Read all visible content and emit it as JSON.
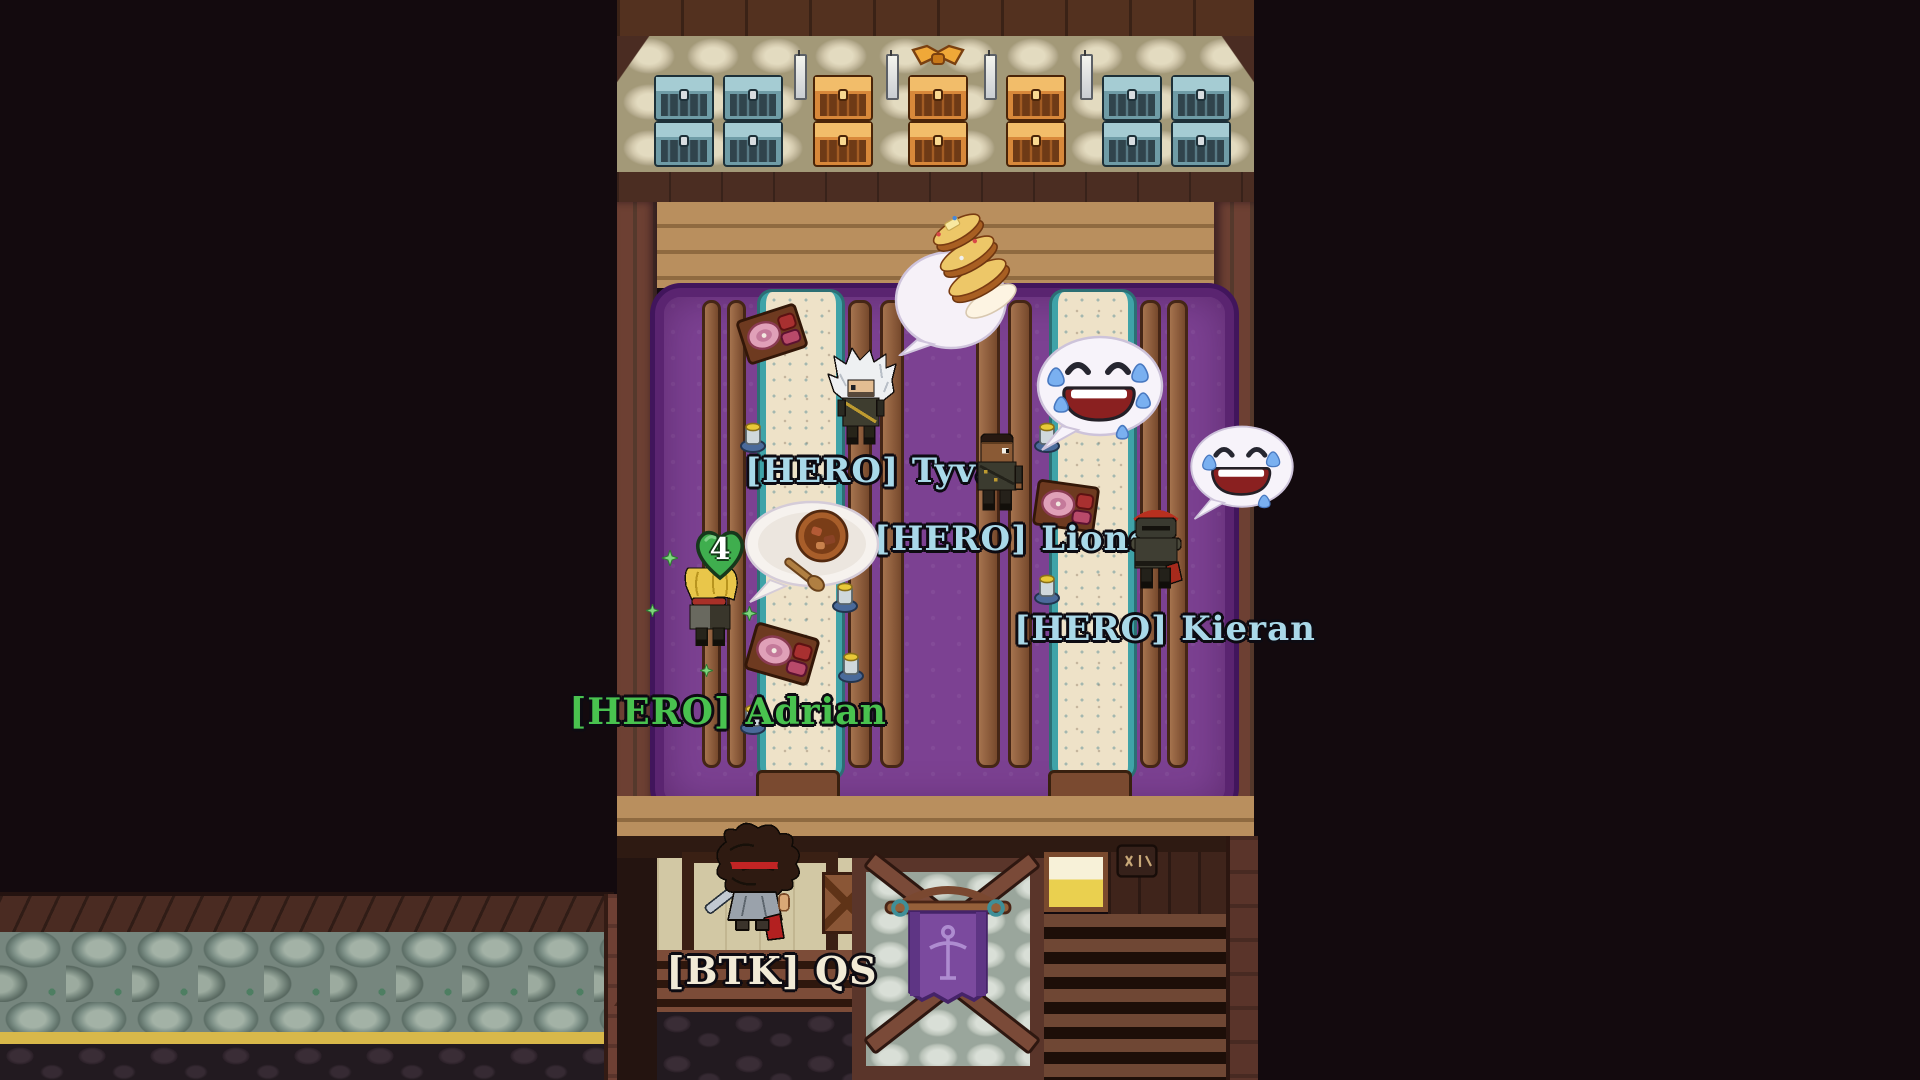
{
  "scene": {
    "name": "tavern-hall"
  },
  "players": [
    {
      "id": "tyva",
      "guild_tag": "[HERO]",
      "name": "Tyva",
      "label": "[HERO] Tyva",
      "label_color": "#a9d9e9"
    },
    {
      "id": "lionel",
      "guild_tag": "[HERO]",
      "name": "Lionel",
      "label": "[HERO] Lionel",
      "label_color": "#a9d9e9"
    },
    {
      "id": "kieran",
      "guild_tag": "[HERO]",
      "name": "Kieran",
      "label": "[HERO] Kieran",
      "label_color": "#a9d9e9"
    },
    {
      "id": "adrian",
      "guild_tag": "[HERO]",
      "name": "Adrian",
      "label": "[HERO] Adrian",
      "label_color": "#49c24f"
    },
    {
      "id": "qs",
      "guild_tag": "[BTK]",
      "name": "QS",
      "label": "[BTK] QS",
      "label_color": "#f1ead6"
    }
  ],
  "heal_counter": {
    "value": "4",
    "heart_color": "#3fae4e"
  },
  "emotes": [
    {
      "near": "tyva",
      "type": "pancakes-emote"
    },
    {
      "near": "lionel",
      "type": "laughing-crying-emote"
    },
    {
      "near": "kieran",
      "type": "laughing-crying-emote"
    },
    {
      "near": "adrian",
      "type": "stew-bowl-emote"
    }
  ],
  "furniture": {
    "chests": [
      "teal",
      "teal",
      "orange",
      "orange-ribbon",
      "orange",
      "teal",
      "teal"
    ],
    "banner_emblem": "sword",
    "table_items": [
      "ham-board",
      "ham-board",
      "ham-board",
      "mug",
      "mug",
      "mug",
      "mug",
      "mug",
      "mug"
    ]
  },
  "colors": {
    "background": "#130a0e",
    "carpet": "#7c4192",
    "carpet_border": "#5a2470",
    "wood_floor": "#b18757",
    "wall_stone": "#d3c9ad",
    "chest_teal": "#7fb2bd",
    "chest_orange": "#e08f3f",
    "runner_cream": "#eee2c8",
    "runner_teal": "#3fa3a8",
    "label_member": "#a9d9e9",
    "label_self": "#49c24f",
    "label_other": "#f1ead6",
    "heart_green": "#3fae4e",
    "banner_purple": "#7b4a9e",
    "stone_wall": "#8fa098",
    "trim_gold": "#d8b84a"
  }
}
